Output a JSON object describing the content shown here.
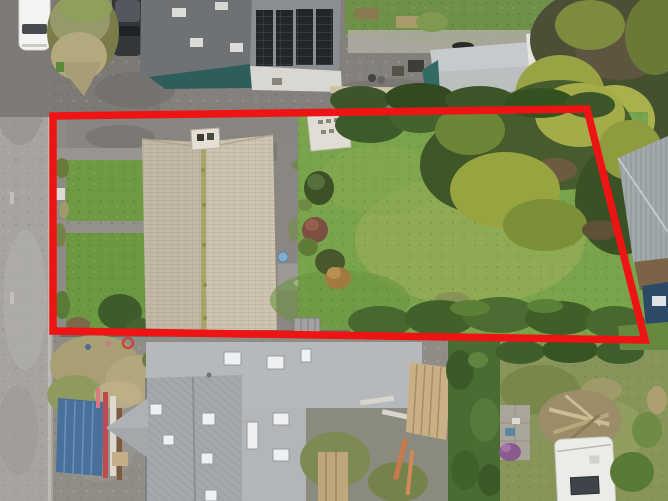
{
  "scene": {
    "type": "aerial-drone-photograph",
    "description": "Overhead drone view of a residential plot for sale outlined in red: beige hip-roofed house with long rear lawn and mature trees, road to the left, neighbouring solar-panel building above, grey new-build house under construction below, neighbour garden with caravan bottom-right.",
    "boundary": {
      "label": "property-boundary-outline",
      "color": "#ee1414",
      "stroke_width": 7.5,
      "points": "53,116 587,109 645,340 53,331"
    }
  },
  "colors": {
    "boundary_red": "#ee1414",
    "road_grey": "#a7a4a0",
    "driveway_asphalt": "#7e7b77",
    "house_roof_beige": "#c8bfad",
    "ridge_moss": "#a6a05e",
    "lawn_green": "#7aa44b",
    "front_grass_green": "#6f9a44",
    "hedge_dark_green": "#41602a",
    "tree_yellow_green": "#9aa344",
    "tree_dark_green": "#465c2c",
    "solar_roof_grey": "#6f7274",
    "solar_panel_black": "#22262b",
    "awning_teal": "#2e5e5b",
    "garage_roof_grey": "#c7cacc",
    "new_build_flat_roof": "#b5b8bc",
    "new_build_pitched_roof": "#a4a8ac",
    "skylight_white": "#eef0f2",
    "container_blue": "#49709a",
    "timber_tan": "#c9b185",
    "caravan_white": "#ebebe8",
    "metal_roof_grey": "#a2a9ad",
    "shed_blue": "#2c4a68"
  },
  "objects": [
    {
      "name": "road",
      "desc": "tarmac road along left edge"
    },
    {
      "name": "parked-white-car",
      "desc": "white car parked top left"
    },
    {
      "name": "parked-dark-car",
      "desc": "dark car parked beside bush"
    },
    {
      "name": "roadside-bush",
      "desc": "scrubby bush between parked cars"
    },
    {
      "name": "solar-panel-building",
      "desc": "neighbouring building with four rooftop solar arrays and teal canopy"
    },
    {
      "name": "detached-garage",
      "desc": "light grey pitched garage roof, top right"
    },
    {
      "name": "outlined-property",
      "desc": "plot outlined in red"
    },
    {
      "name": "main-house",
      "desc": "beige tiled hip roof with chimney and mossy ridge"
    },
    {
      "name": "rear-extension",
      "desc": "small flat-roof extension with water butt"
    },
    {
      "name": "front-lawns",
      "desc": "two front grass squares divided by paths"
    },
    {
      "name": "garden-shed",
      "desc": "white shed at top of rear garden"
    },
    {
      "name": "rear-lawn",
      "desc": "long green rear lawn"
    },
    {
      "name": "shrub-border",
      "desc": "bushes along middle of garden"
    },
    {
      "name": "mature-trees",
      "desc": "large yellow-green conifers on right of plot"
    },
    {
      "name": "boundary-hedge",
      "desc": "hedge rows along top and bottom boundaries"
    },
    {
      "name": "construction-site",
      "desc": "building site below the plot"
    },
    {
      "name": "blue-container",
      "desc": "blue container/panels with red poles"
    },
    {
      "name": "new-build-house",
      "desc": "grey-roofed house under construction with roof windows"
    },
    {
      "name": "timber-stack",
      "desc": "stacked timber planks"
    },
    {
      "name": "neighbour-garden",
      "desc": "garden with branch pile and patio"
    },
    {
      "name": "caravan",
      "desc": "white caravan with roof solar panel"
    },
    {
      "name": "metal-roof-outbuilding",
      "desc": "corrugated grey roof, right edge"
    },
    {
      "name": "blue-shed",
      "desc": "dark blue shed, right edge"
    }
  ]
}
